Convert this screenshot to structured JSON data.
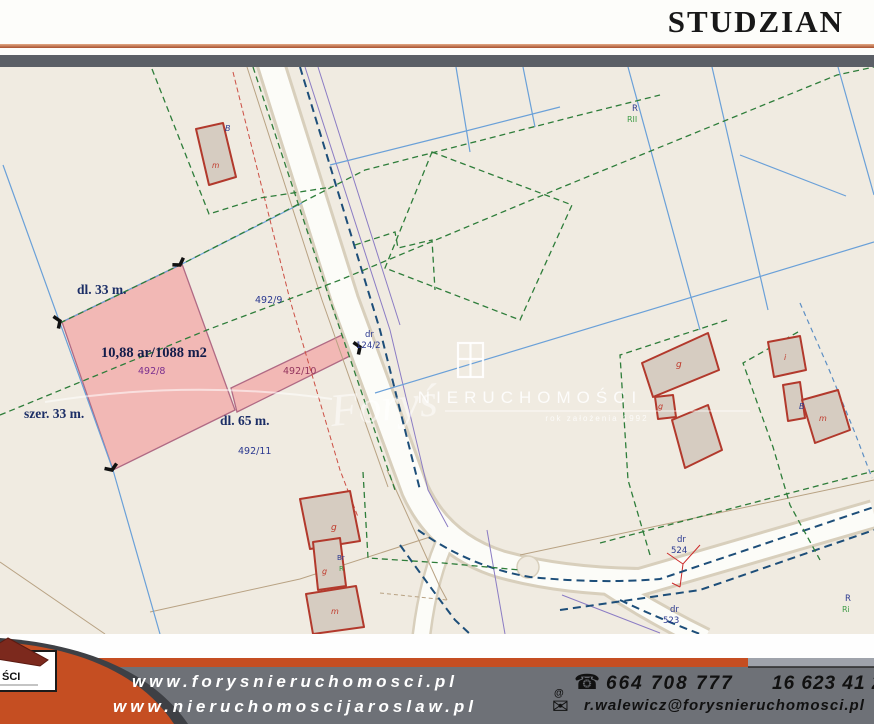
{
  "header": {
    "title": "STUDZIAN"
  },
  "map": {
    "highlight": {
      "parcel_number": "492/8",
      "area_text": "10,88 ar/1088 m2",
      "front_label": "dl. 33 m.",
      "width_label": "szer. 33 m.",
      "length_label": "dl. 65 m."
    },
    "labels": [
      {
        "t": "dl. 33 m.",
        "x": 77,
        "y": 227,
        "s": 13.5,
        "c": "#1c2e66",
        "f": "serif",
        "w": "bold"
      },
      {
        "t": "szer. 33 m.",
        "x": 24,
        "y": 351,
        "s": 13.5,
        "c": "#1c2e66",
        "f": "serif",
        "w": "bold"
      },
      {
        "t": "dl. 65 m.",
        "x": 220,
        "y": 358,
        "s": 13.5,
        "c": "#1c2e66",
        "f": "serif",
        "w": "bold"
      },
      {
        "t": "10,88 ar/1088 m2",
        "x": 101,
        "y": 290,
        "s": 14.5,
        "c": "#131c4a",
        "f": "serif",
        "w": "bold"
      },
      {
        "t": "492/8",
        "x": 138,
        "y": 307,
        "s": 9.5,
        "c": "#7b2f8e"
      },
      {
        "t": "492/9",
        "x": 255,
        "y": 236,
        "s": 9.5,
        "c": "#2b3990"
      },
      {
        "t": "492/10",
        "x": 283,
        "y": 307,
        "s": 9.5,
        "c": "#93355e"
      },
      {
        "t": "492/11",
        "x": 238,
        "y": 387,
        "s": 9.5,
        "c": "#2b3990"
      },
      {
        "t": "dr",
        "x": 365,
        "y": 270,
        "s": 8.5,
        "c": "#2b3990"
      },
      {
        "t": "124/2",
        "x": 356,
        "y": 281,
        "s": 8.5,
        "c": "#2b3990"
      },
      {
        "t": "dr",
        "x": 677,
        "y": 475,
        "s": 8.5,
        "c": "#2b3990"
      },
      {
        "t": "524",
        "x": 671,
        "y": 486,
        "s": 8.5,
        "c": "#2b3990"
      },
      {
        "t": "dr",
        "x": 670,
        "y": 545,
        "s": 8.5,
        "c": "#2b3990"
      },
      {
        "t": "523",
        "x": 663,
        "y": 556,
        "s": 8.5,
        "c": "#2b3990"
      },
      {
        "t": "R",
        "x": 845,
        "y": 534,
        "s": 8.5,
        "c": "#2b3990"
      },
      {
        "t": "Ri",
        "x": 842,
        "y": 545,
        "s": 8,
        "c": "#3d9b45"
      },
      {
        "t": "R",
        "x": 632,
        "y": 44,
        "s": 8.5,
        "c": "#2b3990"
      },
      {
        "t": "RII",
        "x": 627,
        "y": 55,
        "s": 8,
        "c": "#3d9b45"
      },
      {
        "t": "B",
        "x": 225,
        "y": 64,
        "s": 8,
        "c": "#2b3990",
        "i": true
      },
      {
        "t": "m",
        "x": 212,
        "y": 101,
        "s": 7.5,
        "c": "#c0392b",
        "i": true
      },
      {
        "t": "g",
        "x": 676,
        "y": 300,
        "s": 9,
        "c": "#c0392b",
        "i": true
      },
      {
        "t": "g",
        "x": 658,
        "y": 342,
        "s": 8,
        "c": "#c0392b",
        "i": true
      },
      {
        "t": "i",
        "x": 784,
        "y": 293,
        "s": 8,
        "c": "#c0392b",
        "i": true
      },
      {
        "t": "B",
        "x": 799,
        "y": 342,
        "s": 8,
        "c": "#2b3990",
        "i": true
      },
      {
        "t": "m",
        "x": 819,
        "y": 354,
        "s": 8,
        "c": "#c0392b",
        "i": true
      },
      {
        "t": "g",
        "x": 331,
        "y": 463,
        "s": 9,
        "c": "#c0392b",
        "i": true
      },
      {
        "t": "g",
        "x": 322,
        "y": 507,
        "s": 8,
        "c": "#c0392b",
        "i": true
      },
      {
        "t": "m",
        "x": 331,
        "y": 547,
        "s": 8,
        "c": "#c0392b",
        "i": true
      },
      {
        "t": "Br",
        "x": 337,
        "y": 493,
        "s": 7,
        "c": "#2b3990"
      },
      {
        "t": "R",
        "x": 339,
        "y": 504,
        "s": 7,
        "c": "#3d9b45"
      }
    ]
  },
  "watermark": {
    "brand": "NIERUCHOMOŚCI",
    "tagline": "rok założenia 1992",
    "signature": "Foryś"
  },
  "footer": {
    "site1": "www.forysnieruchomosci.pl",
    "site2": "www.nieruchomoscijaroslaw.pl",
    "phone1": "664 708 777",
    "phone2": "16 623 41 27",
    "email": "r.walewicz@forysnieruchomosci.pl",
    "logo_visible_text": "ŚCI"
  },
  "colors": {
    "accent_orange": "#c54e22",
    "footer_gray": "#6e7177",
    "map_bg": "#f0ebe1",
    "highlight_pink": "#f2b3b0",
    "building_red": "#b2392c",
    "boundary_green": "#2e7d3a",
    "utility_blue": "#6aa0d8",
    "label_navy": "#2b3990"
  }
}
